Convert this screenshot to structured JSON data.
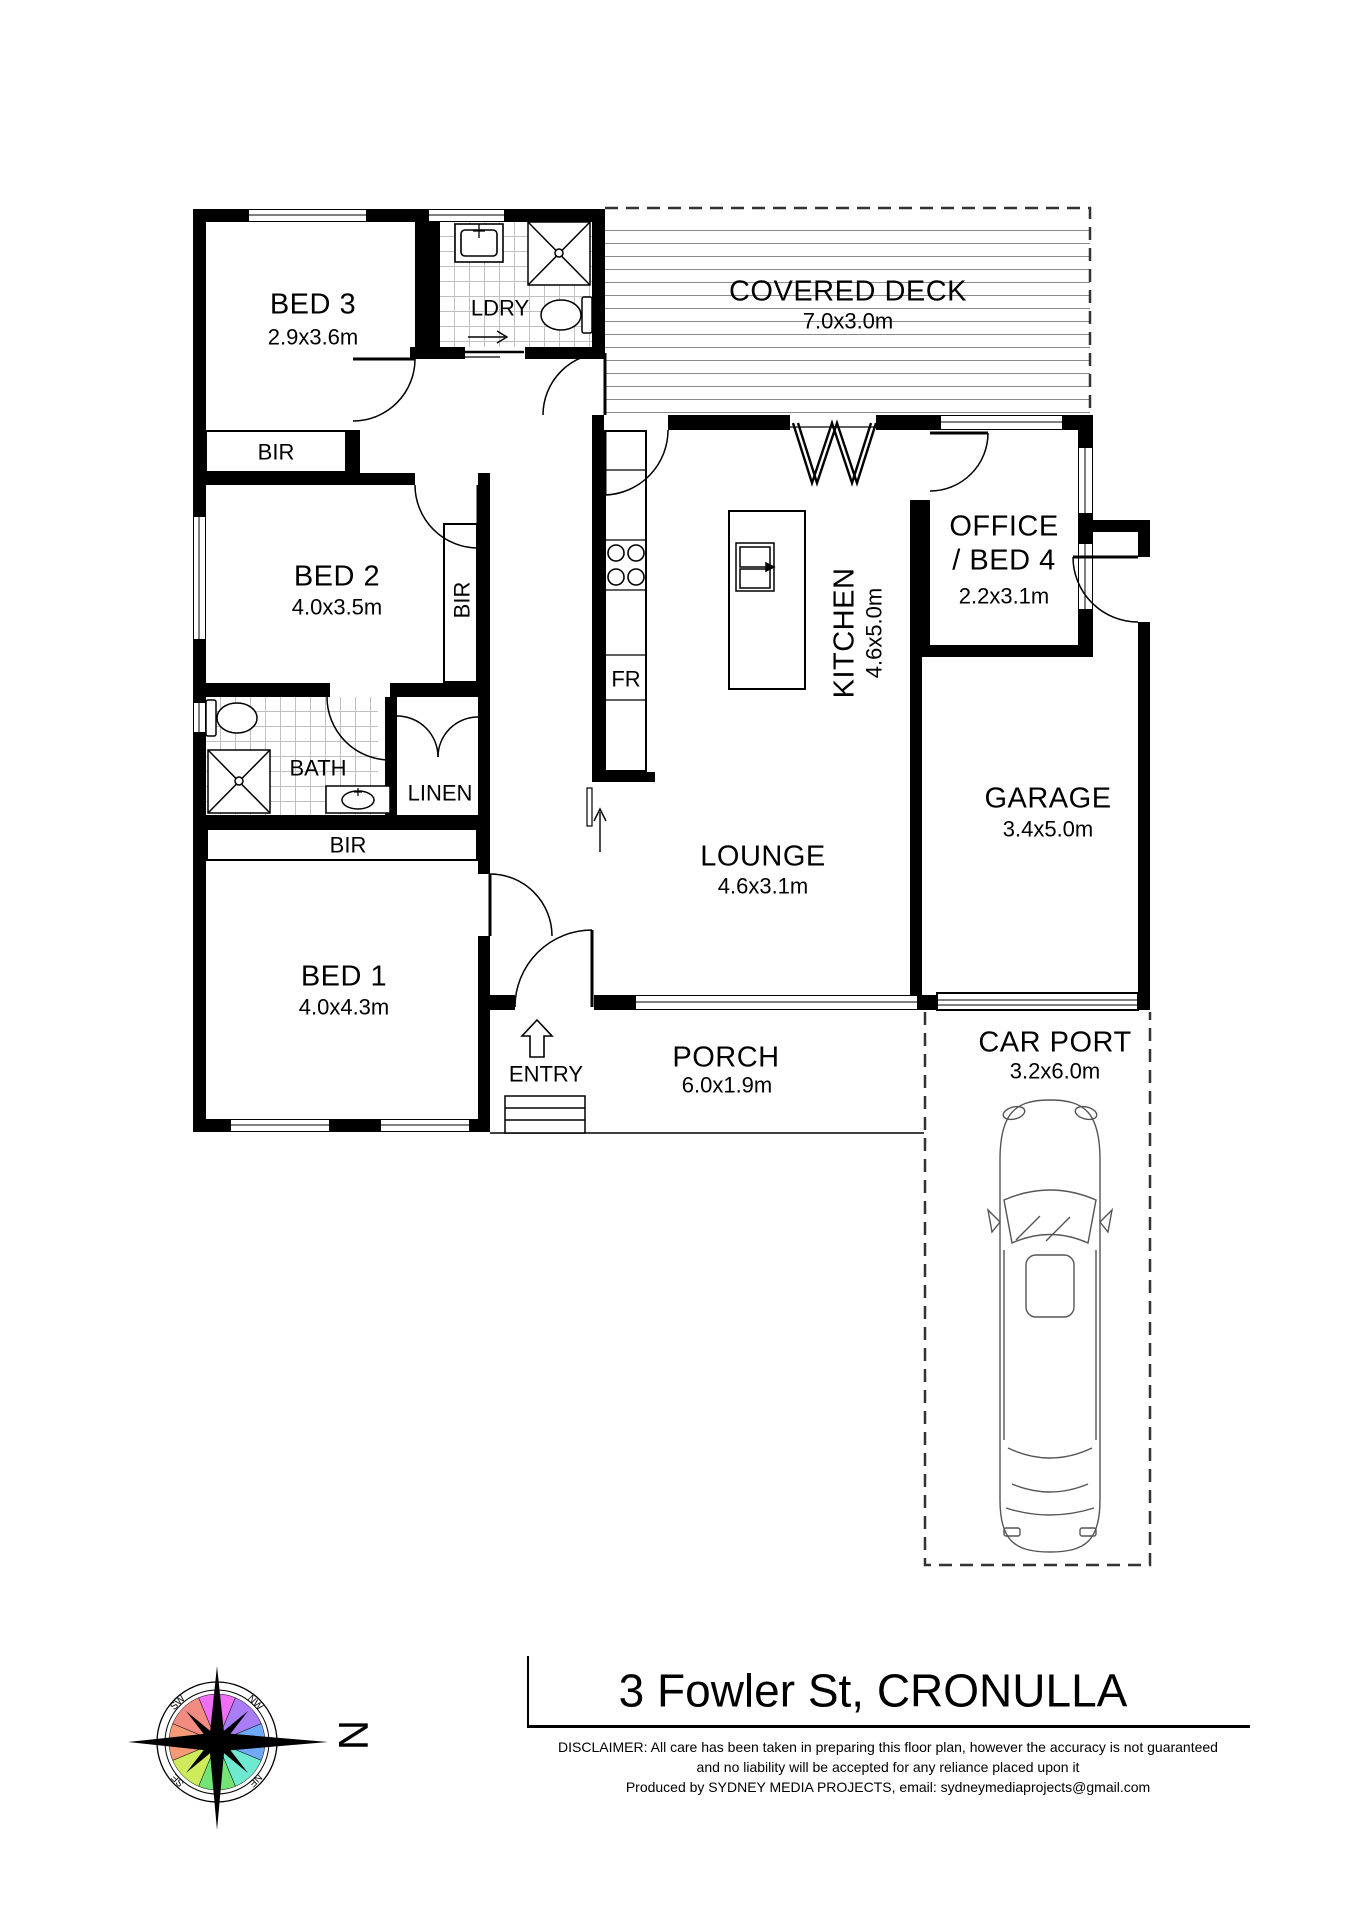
{
  "plan": {
    "rooms": {
      "bed3": {
        "name": "BED 3",
        "dims": "2.9x3.6m"
      },
      "ldry": {
        "name": "LDRY"
      },
      "deck": {
        "name": "COVERED DECK",
        "dims": "7.0x3.0m"
      },
      "bed2": {
        "name": "BED 2",
        "dims": "4.0x3.5m"
      },
      "kitchen": {
        "name": "KITCHEN",
        "dims": "4.6x5.0m"
      },
      "office": {
        "name": "OFFICE",
        "name2": "/ BED 4",
        "dims": "2.2x3.1m"
      },
      "garage": {
        "name": "GARAGE",
        "dims": "3.4x5.0m"
      },
      "bath": {
        "name": "BATH"
      },
      "linen": {
        "name": "LINEN"
      },
      "bed1": {
        "name": "BED 1",
        "dims": "4.0x4.3m"
      },
      "lounge": {
        "name": "LOUNGE",
        "dims": "4.6x3.1m"
      },
      "porch": {
        "name": "PORCH",
        "dims": "6.0x1.9m"
      },
      "carport": {
        "name": "CAR PORT",
        "dims": "3.2x6.0m"
      },
      "entry": {
        "name": "ENTRY"
      }
    },
    "fixtures": {
      "bir": "BIR",
      "fridge": "FR"
    },
    "colors": {
      "wall": "#000000",
      "deck_line": "#8a8a8a",
      "tile_line": "#c0c0c0"
    }
  },
  "compass": {
    "north": "N",
    "nw": "NW",
    "ne": "NE",
    "se": "SE",
    "sw": "SW",
    "colors": {
      "magenta": "#ee6ff2",
      "purple": "#a97df5",
      "blue": "#6fa9f7",
      "cyan": "#6fe9cf",
      "green": "#74e574",
      "yellowgreen": "#cdeb5a",
      "orange": "#f59a76",
      "red": "#f28b82"
    }
  },
  "title_block": {
    "address": "3 Fowler St, CRONULLA",
    "disclaimer_line1": "DISCLAIMER: All care has been taken in preparing this floor plan, however the accuracy is not guaranteed",
    "disclaimer_line2": "and no liability will be accepted for any reliance placed upon it",
    "produced_line": "Produced by SYDNEY MEDIA PROJECTS,     email: sydneymediaprojects@gmail.com"
  }
}
